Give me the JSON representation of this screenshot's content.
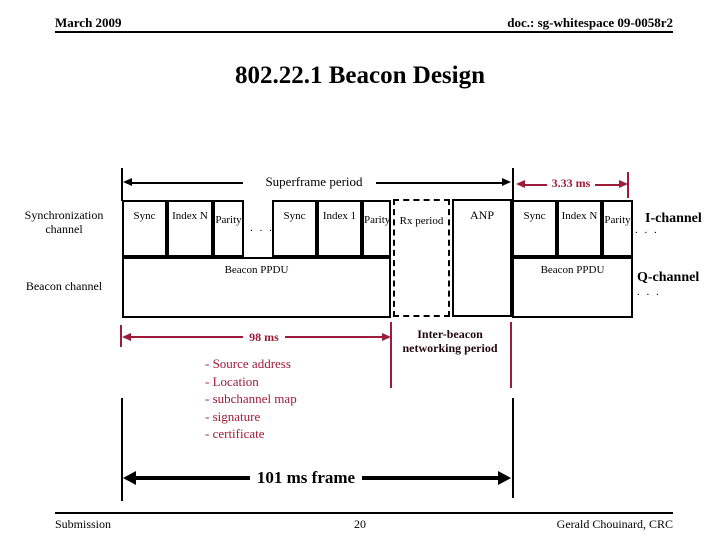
{
  "colors": {
    "accent": "#9d1c3a",
    "ink": "#000000"
  },
  "header": {
    "date": "March 2009",
    "doc_id": "doc.: sg-whitespace 09-0058r2"
  },
  "title": "802.22.1 Beacon Design",
  "diagram": {
    "superframe_label": "Superframe period",
    "beacon_period_label": "3.33 ms",
    "sync_channel_label": "Synchronization channel",
    "beacon_channel_label": "Beacon channel",
    "i_channel_label": "I-channel",
    "q_channel_label": "Q-channel",
    "continuation_dots": ". . .",
    "groups": [
      {
        "boxes": [
          "Sync",
          "Index N",
          "Parity"
        ]
      },
      {
        "boxes": [
          "Sync",
          "Index 1",
          "Parity"
        ]
      },
      {
        "boxes": [
          "Sync",
          "Index N",
          "Parity"
        ]
      }
    ],
    "rx_period_label": "Rx period",
    "anp_label": "ANP",
    "beacon_ppdu_label": "Beacon PPDU",
    "active_period_label": "98 ms",
    "inter_beacon_label": "Inter-beacon networking period",
    "beacon_payload_items": [
      "- Source address",
      "- Location",
      "- subchannel map",
      "- signature",
      "- certificate"
    ],
    "frame_label": "101 ms frame"
  },
  "footer": {
    "left": "Submission",
    "page": "20",
    "right": "Gerald Chouinard, CRC"
  }
}
